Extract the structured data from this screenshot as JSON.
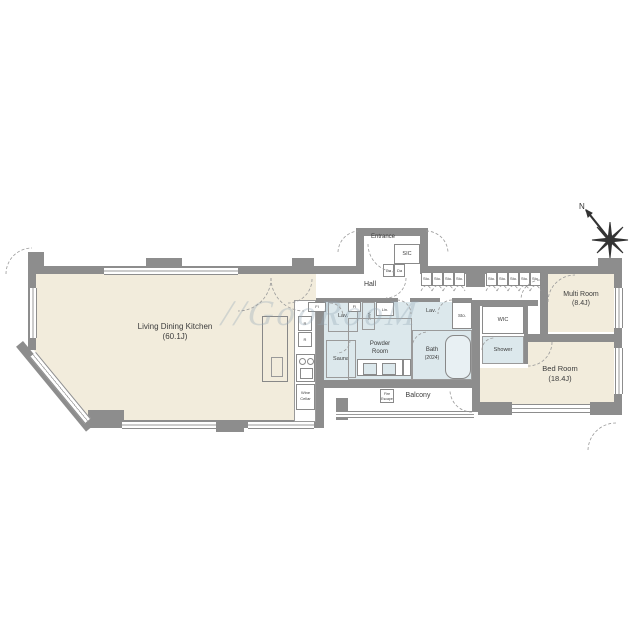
{
  "watermark": {
    "prefix": "//",
    "text": "GooRooM"
  },
  "compass": {
    "north": "N"
  },
  "rooms": {
    "ldk": {
      "name": "Living Dining Kitchen",
      "size": "(60.1J)"
    },
    "multi_room": {
      "name": "Multi Room",
      "size": "(8.4J)"
    },
    "bed_room": {
      "name": "Bed Room",
      "size": "(18.4J)"
    },
    "entrance": "Entrance",
    "sic": "SIC",
    "hall": "Hall",
    "powder_room": {
      "line1": "Powder",
      "line2": "Room"
    },
    "bath": {
      "name": "Bath",
      "size": "(2024)"
    },
    "sauna": "Sauna",
    "lav_left": "Lav.",
    "lav_right": "Lav.",
    "wc": "W/C",
    "linen": "Lin.",
    "wic": "WIC",
    "shower": "Shower",
    "sto_small": "Sto.",
    "balcony": "Balcony",
    "wine_cellar": {
      "line1": "Wine",
      "line2": "Cellar"
    }
  },
  "fixtures": {
    "fi": "FI",
    "fridge": "R",
    "shoe_box": "Da",
    "fire_escape": {
      "line1": "Fire",
      "line2": "Escape"
    }
  },
  "storage_row_a": [
    "Sto.",
    "Sto.",
    "Sto.",
    "Sto."
  ],
  "storage_row_b": [
    "Sto.",
    "Sto.",
    "Sto.",
    "Sto.",
    "Sto."
  ],
  "colors": {
    "wall": "#8d8d8d",
    "room_beige": "#f2ecdc",
    "wet_blue": "#dce8ec",
    "line": "#999999"
  }
}
